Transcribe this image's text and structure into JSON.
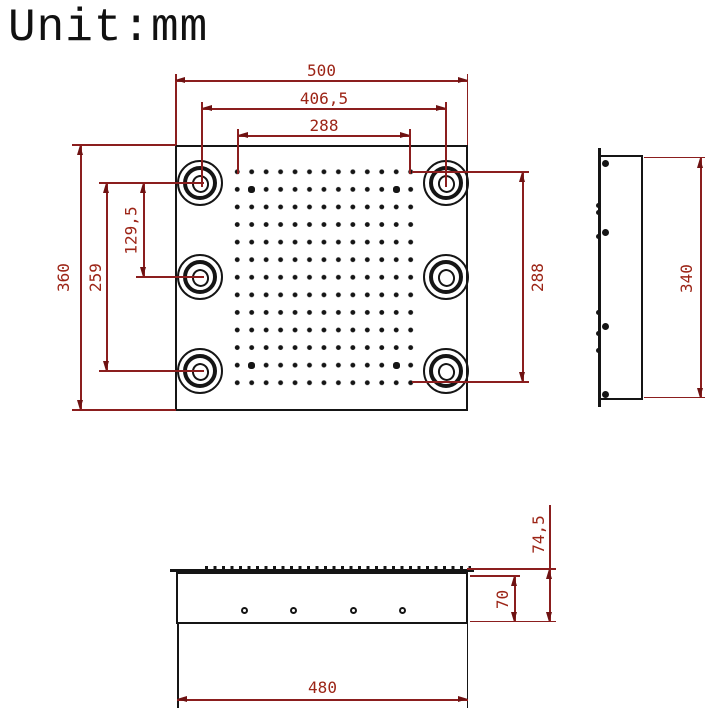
{
  "title": "Unit:mm",
  "dimensions": {
    "top_view": {
      "overall_width": "500",
      "hole_spacing_width": "406,5",
      "grid_width": "288",
      "overall_height": "360",
      "hole_spacing_height": "259",
      "hole_spacing_half_height": "129,5",
      "grid_height": "288"
    },
    "side_view": {
      "overall_height": "340"
    },
    "front_view": {
      "body_width": "480",
      "body_height": "70",
      "overall_height": "74,5"
    }
  },
  "features": {
    "mount_hole_count": 6,
    "nozzle_grid": {
      "rows": 13,
      "cols": 13
    },
    "front_hole_count": 4,
    "side_hole_count": 4
  },
  "colors": {
    "outline": "#151515",
    "dimension_line": "#8b1e1e",
    "dimension_text": "#9c2416",
    "background": "#ffffff"
  }
}
